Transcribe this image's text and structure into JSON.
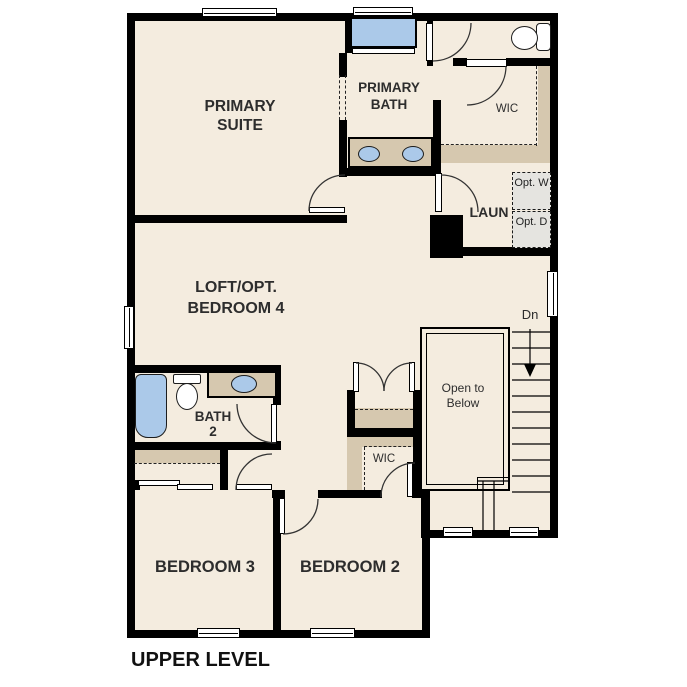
{
  "plan": {
    "level_title": "UPPER LEVEL",
    "rooms": {
      "primary_suite": "PRIMARY SUITE",
      "primary_bath": "PRIMARY BATH",
      "primary_wic": "WIC",
      "laundry": "LAUN",
      "optional_washer": "Opt. W",
      "optional_dryer": "Opt. D",
      "loft": "LOFT/OPT. BEDROOM 4",
      "bath2": "BATH 2",
      "bedroom2_wic": "WIC",
      "bedroom3": "BEDROOM 3",
      "bedroom2": "BEDROOM 2"
    },
    "stairs": {
      "direction_label": "Dn",
      "open_to_below": "Open to Below"
    },
    "colors": {
      "background": "#ffffff",
      "floor": "#f4ecdf",
      "walls": "#000000",
      "counters_closets": "#d6c8af",
      "fixtures_blue": "#abc9e9",
      "optional_appliance_fill": "#e5e4e0",
      "text": "#2d2d2d"
    }
  }
}
